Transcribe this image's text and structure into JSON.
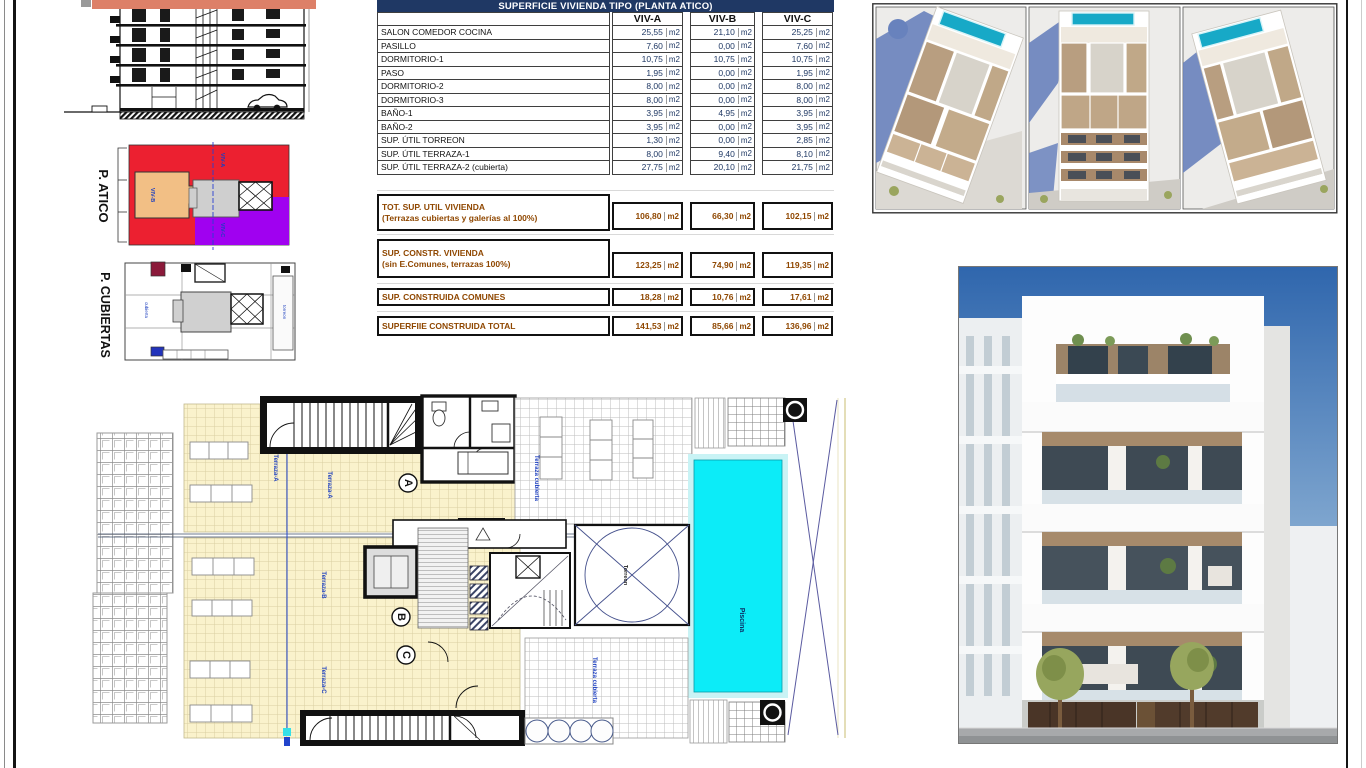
{
  "table": {
    "title": "SUPERFICIE VIVIENDA TIPO  (PLANTA ATICO)",
    "col_headers": [
      "VIV-A",
      "VIV-B",
      "VIV-C"
    ],
    "unit": "m2",
    "rows": [
      [
        "SALON COMEDOR COCINA",
        "25,55",
        "21,10",
        "25,25"
      ],
      [
        "PASILLO",
        "7,60",
        "0,00",
        "7,60"
      ],
      [
        "DORMITORIO-1",
        "10,75",
        "10,75",
        "10,75"
      ],
      [
        "PASO",
        "1,95",
        "0,00",
        "1,95"
      ],
      [
        "DORMITORIO-2",
        "8,00",
        "0,00",
        "8,00"
      ],
      [
        "DORMITORIO-3",
        "8,00",
        "0,00",
        "8,00"
      ],
      [
        "BAÑO-1",
        "3,95",
        "4,95",
        "3,95"
      ],
      [
        "BAÑO-2",
        "3,95",
        "0,00",
        "3,95"
      ],
      [
        "SUP. ÚTIL TORREON",
        "1,30",
        "0,00",
        "2,85"
      ],
      [
        "SUP. ÚTIL TERRAZA-1",
        "8,00",
        "9,40",
        "8,10"
      ],
      [
        "SUP. ÚTIL TERRAZA-2 (cubierta)",
        "27,75",
        "20,10",
        "21,75"
      ]
    ],
    "summary": [
      {
        "label": "TOT. SUP. UTIL VIVIENDA",
        "sub": "(Terrazas cubiertas y galerías al 100%)",
        "values": [
          "106,80",
          "66,30",
          "102,15"
        ]
      },
      {
        "label": "SUP. CONSTR. VIVIENDA",
        "sub": "(sin E.Comunes, terrazas 100%)",
        "values": [
          "123,25",
          "74,90",
          "119,35"
        ]
      },
      {
        "label": "SUP. CONSTRUIDA COMUNES",
        "sub": "",
        "values": [
          "18,28",
          "10,76",
          "17,61"
        ]
      },
      {
        "label": "SUPERFIIE CONSTRUIDA TOTAL",
        "sub": "",
        "values": [
          "141,53",
          "85,66",
          "136,96"
        ]
      }
    ]
  },
  "side_plans": {
    "atico_label": "P. ATICO",
    "cubiertas_label": "P. CUBIERTAS",
    "viv_a": "VIV-A",
    "viv_b": "VIV-B",
    "viv_c": "VIV-C",
    "cubierta_note": "cubierta",
    "torreon_note": "torreon"
  },
  "floor_plan": {
    "unit_labels": [
      "A",
      "B",
      "C"
    ],
    "annotations": {
      "terraza_a": "Terraza-A",
      "terraza_b": "Terraza-B",
      "terraza_c": "Terraza-C",
      "terraza_cubierta": "Terraza cubierta",
      "piscina": "Piscina",
      "torreon": "Torreon"
    }
  },
  "colors": {
    "table_header_bg": "#1f3864",
    "value_text": "#1f3864",
    "summary_text": "#8f4700",
    "atico_red": "#ec2030",
    "atico_purple": "#a001f0",
    "atico_orange": "#f2bf85",
    "core_gray": "#cfcfcf",
    "pool_cyan": "#0cecf8",
    "terrace_yellow": "#faf2cc",
    "render_pool_teal": "#17a9c7",
    "sky_blue": "#2f66ad",
    "salmon_band": "#dd8068",
    "annotation_blue": "#1d3fbf"
  }
}
